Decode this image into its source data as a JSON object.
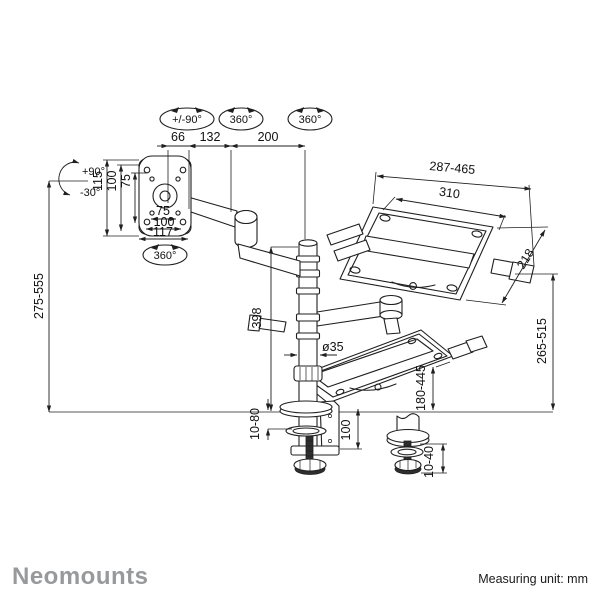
{
  "page": {
    "background": "#ffffff",
    "line_color": "#1f1f1f"
  },
  "badges": {
    "pan_range": "+/-90°",
    "rotation_arm": "360°",
    "rotation_pole": "360°",
    "rotation_vesa": "360°",
    "tilt_up": "+90°",
    "tilt_down": "-30°"
  },
  "dimensions": {
    "offset_66": "66",
    "arm_front_132": "132",
    "arm_rear_200": "200",
    "vesa_v_115": "115",
    "vesa_v_100": "100",
    "vesa_v_75": "75",
    "vesa_h_75": "75",
    "vesa_h_100": "100",
    "vesa_h_117": "117",
    "monitor_height_range": "275-555",
    "tray_width_range": "287-465",
    "tray_inner_width": "310",
    "tray_depth": "218",
    "laptop_height_range": "265-515",
    "pole_height": "398",
    "pole_diameter": "ø35",
    "lower_tray_range": "180-445",
    "clamp_range": "10-80",
    "clamp_depth": "100",
    "grommet_range": "10-40"
  },
  "footer": {
    "brand": "Neomounts",
    "brand_color": "#98999b",
    "measuring_unit": "Measuring unit: mm"
  }
}
